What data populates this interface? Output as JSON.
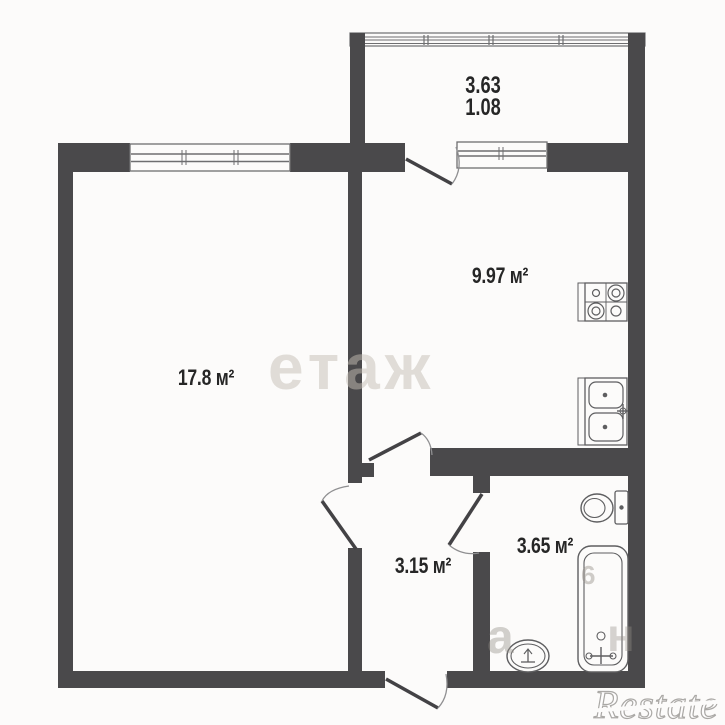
{
  "plan": {
    "balcony": {
      "dim_width": "3.63",
      "dim_depth": "1.08"
    },
    "rooms": {
      "living_room": {
        "area": "17.8 м²"
      },
      "kitchen": {
        "area": "9.97 м²"
      },
      "hallway": {
        "area": "3.15 м²"
      },
      "bathroom": {
        "area": "3.65 м²"
      }
    },
    "fixtures": [
      "stove",
      "kitchen-sink",
      "toilet",
      "bathtub",
      "bathroom-sink"
    ]
  },
  "watermarks": {
    "center": "етаж",
    "fragment_a": "а",
    "fragment_n": "н",
    "fragment_6": "6",
    "brand": "Restate"
  },
  "colors": {
    "wall": "#4a494b",
    "background": "#fcfbfa",
    "label": "#262626",
    "fixture_line": "#5e5e60"
  }
}
